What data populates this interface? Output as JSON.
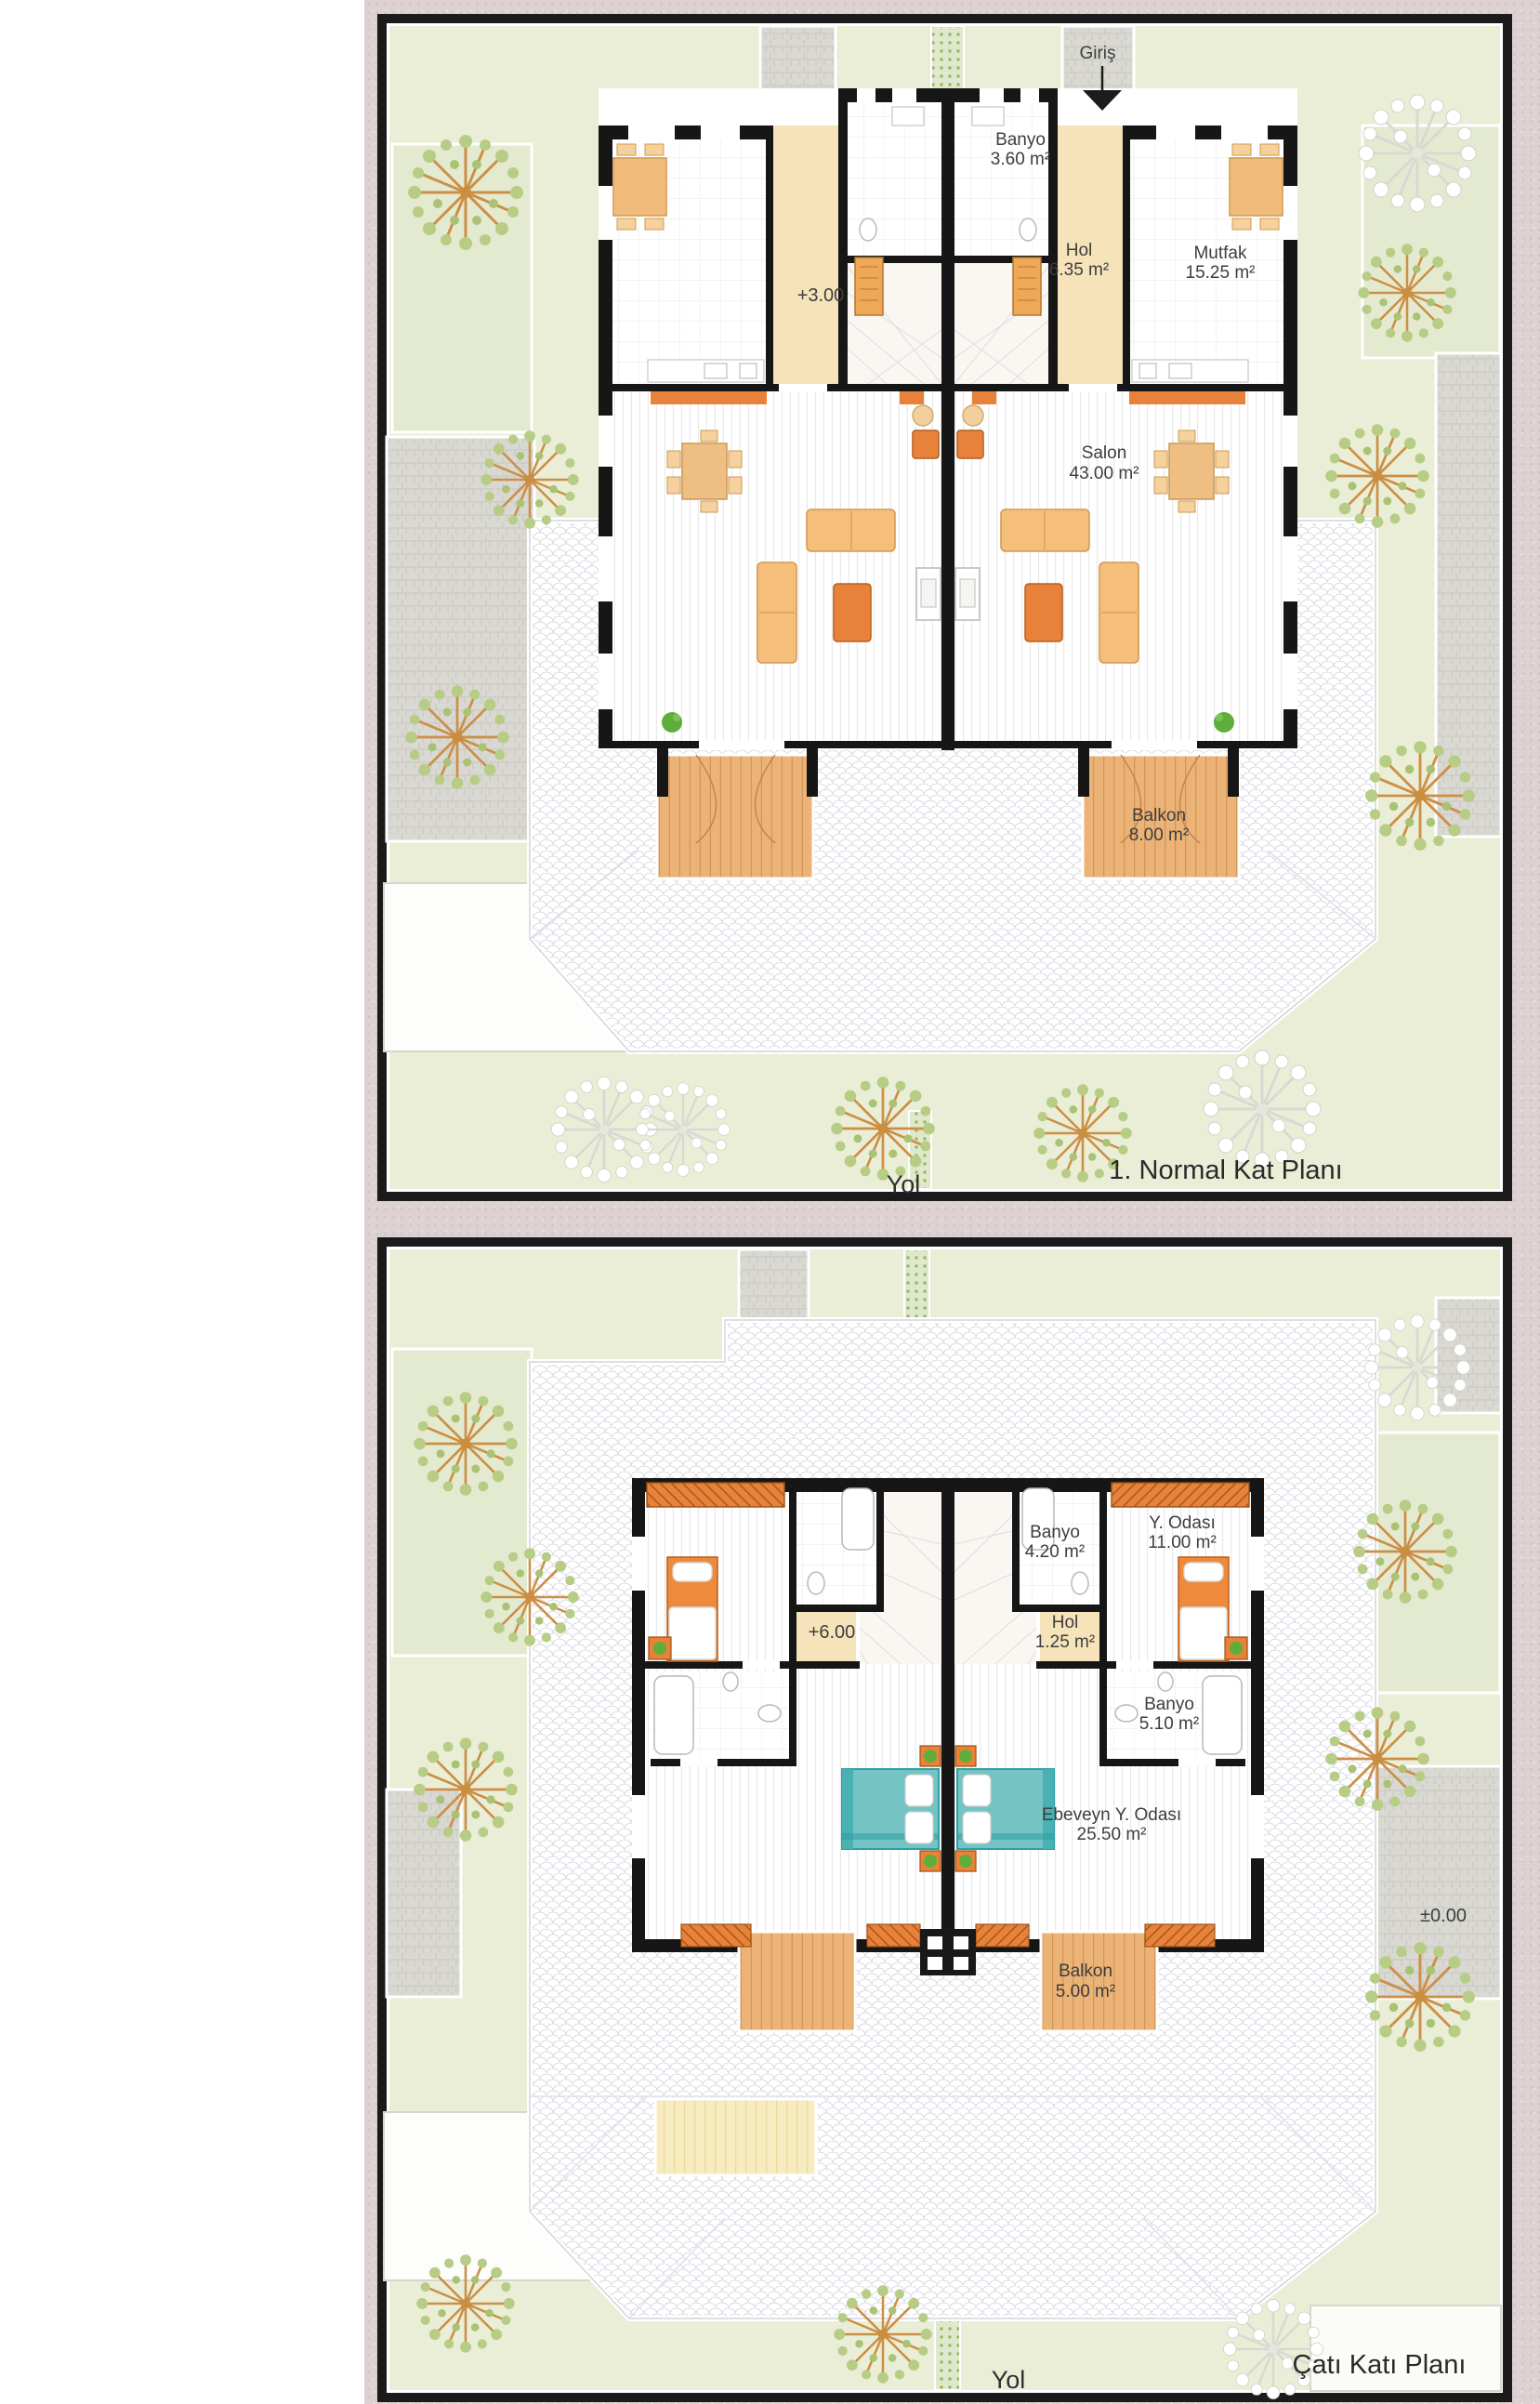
{
  "sheet": {
    "type": "architectural-floor-plans",
    "language": "Turkish"
  },
  "plan1": {
    "title": "1. Normal Kat Planı",
    "road_label": "Yol",
    "entrance_label": "Giriş",
    "level_label": "+3.00",
    "rooms": {
      "banyo": {
        "name": "Banyo",
        "area": "3.60 m²"
      },
      "hol": {
        "name": "Hol",
        "area": "6.35 m²"
      },
      "mutfak": {
        "name": "Mutfak",
        "area": "15.25 m²"
      },
      "salon": {
        "name": "Salon",
        "area": "43.00 m²"
      },
      "balkon": {
        "name": "Balkon",
        "area": "8.00 m²"
      }
    }
  },
  "plan2": {
    "title": "Çatı Katı Planı",
    "road_label": "Yol",
    "level_label": "+6.00",
    "ground_level_label": "±0.00",
    "rooms": {
      "banyo_ust": {
        "name": "Banyo",
        "area": "4.20 m²"
      },
      "y_odasi": {
        "name": "Y. Odası",
        "area": "11.00 m²"
      },
      "hol": {
        "name": "Hol",
        "area": "1.25 m²"
      },
      "banyo_alt": {
        "name": "Banyo",
        "area": "5.10 m²"
      },
      "ebeveyn": {
        "name": "Ebeveyn Y. Odası",
        "area": "25.50 m²"
      },
      "balkon": {
        "name": "Balkon",
        "area": "5.00 m²"
      }
    }
  },
  "colors": {
    "mat_border": "#ddd1d2",
    "frame": "#1b1b1b",
    "lawn": "#eaeed7",
    "path_gray": "#d9d8d2",
    "wall_black": "#161616",
    "hall_cream": "#f6e3ba",
    "furniture_light_orange": "#f5bf7b",
    "furniture_dark_orange": "#e8823a",
    "deck_wood": "#ecb377",
    "skylight_yellow": "#f7ecc0",
    "bed_teal": "#74c4c6",
    "tree_green": "#b7cd85",
    "roof_line": "#d6d6de"
  }
}
